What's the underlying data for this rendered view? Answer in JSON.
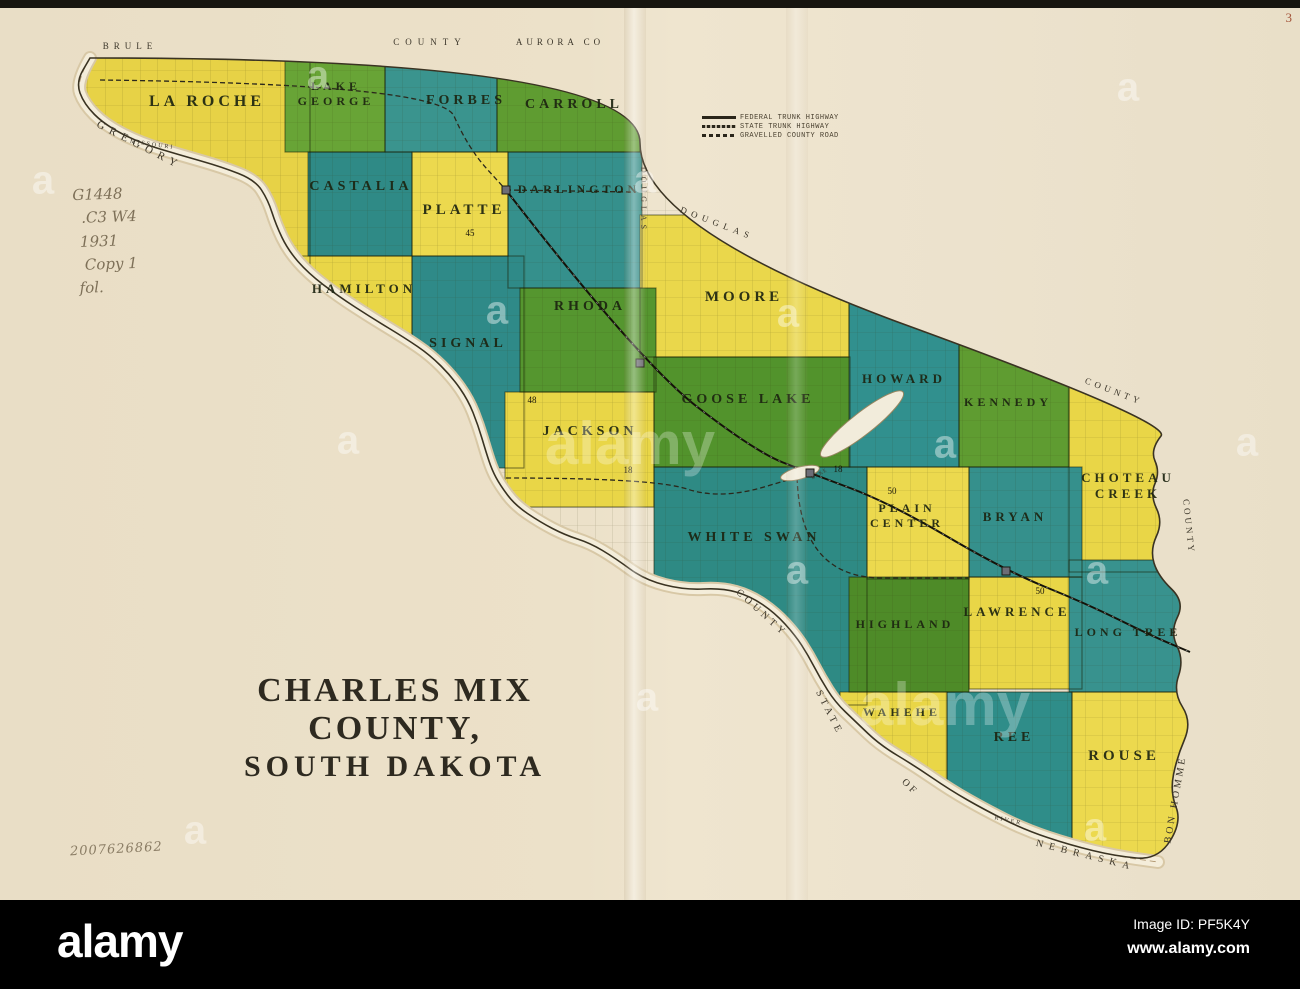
{
  "page": {
    "corner_number": "3",
    "catalog_notes": [
      "G1448",
      ".C3 W4",
      "1931",
      "Copy 1",
      "fol."
    ],
    "accession_number": "2007626862"
  },
  "title": {
    "line1": "CHARLES MIX COUNTY,",
    "line2": "SOUTH DAKOTA"
  },
  "legend": {
    "items": [
      {
        "symbol": "solid",
        "label": "FEDERAL TRUNK HIGHWAY"
      },
      {
        "symbol": "hatched",
        "label": "STATE TRUNK HIGHWAY"
      },
      {
        "symbol": "dashed",
        "label": "GRAVELLED COUNTY ROAD"
      }
    ]
  },
  "map": {
    "colors": {
      "paper": "#ece1c9",
      "ink": "#2b281c",
      "river_band": "#f4edda",
      "river_edge": "#d8c8a6",
      "yellow": "#e9d647",
      "green": "#5f9c31",
      "teal": "#35908c"
    },
    "townships": [
      {
        "name": "LA ROCHE",
        "fill": "#e7d246",
        "x": 70,
        "y": 58,
        "w": 240,
        "h": 210,
        "label": {
          "x": 207,
          "y": 106,
          "size": 16,
          "lines": [
            "LA ROCHE"
          ]
        }
      },
      {
        "name": "LAKE GEORGE",
        "fill": "#68a436",
        "x": 285,
        "y": 58,
        "w": 100,
        "h": 94,
        "label": {
          "x": 336,
          "y": 90,
          "size": 12,
          "lines": [
            "LAKE",
            "GEORGE"
          ]
        }
      },
      {
        "name": "FORBES",
        "fill": "#3a948e",
        "x": 385,
        "y": 58,
        "w": 112,
        "h": 94,
        "label": {
          "x": 466,
          "y": 104,
          "size": 14,
          "lines": [
            "FORBES"
          ]
        }
      },
      {
        "name": "CARROLL",
        "fill": "#5f9c31",
        "x": 497,
        "y": 58,
        "w": 143,
        "h": 94,
        "label": {
          "x": 574,
          "y": 108,
          "size": 14,
          "lines": [
            "CARROLL"
          ]
        }
      },
      {
        "name": "CASTALIA",
        "fill": "#2f8a86",
        "x": 308,
        "y": 152,
        "w": 104,
        "h": 104,
        "label": {
          "x": 361,
          "y": 190,
          "size": 14,
          "lines": [
            "CASTALIA"
          ]
        }
      },
      {
        "name": "PLATTE",
        "fill": "#ecd94e",
        "x": 412,
        "y": 152,
        "w": 96,
        "h": 104,
        "label": {
          "x": 464,
          "y": 214,
          "size": 15,
          "lines": [
            "PLATTE"
          ]
        }
      },
      {
        "name": "DARLINGTON",
        "fill": "#35908c",
        "x": 508,
        "y": 152,
        "w": 134,
        "h": 136,
        "label": {
          "x": 579,
          "y": 193,
          "size": 12,
          "lines": [
            "DARLINGTON"
          ]
        }
      },
      {
        "name": "HAMILTON",
        "fill": "#e9d647",
        "x": 288,
        "y": 256,
        "w": 124,
        "h": 122,
        "label": {
          "x": 364,
          "y": 293,
          "size": 13,
          "lines": [
            "HAMILTON"
          ]
        }
      },
      {
        "name": "MOORE",
        "fill": "#ead74b",
        "x": 640,
        "y": 215,
        "w": 209,
        "h": 142,
        "label": {
          "x": 744,
          "y": 301,
          "size": 15,
          "lines": [
            "MOORE"
          ]
        }
      },
      {
        "name": "SIGNAL",
        "fill": "#2f8a88",
        "x": 412,
        "y": 256,
        "w": 112,
        "h": 212,
        "label": {
          "x": 468,
          "y": 347,
          "size": 14,
          "lines": [
            "SIGNAL"
          ]
        }
      },
      {
        "name": "RHODA",
        "fill": "#55962f",
        "x": 520,
        "y": 288,
        "w": 136,
        "h": 104,
        "label": {
          "x": 590,
          "y": 310,
          "size": 14,
          "lines": [
            "RHODA"
          ]
        }
      },
      {
        "name": "GOOSE LAKE",
        "fill": "#52932c",
        "x": 654,
        "y": 357,
        "w": 196,
        "h": 110,
        "label": {
          "x": 748,
          "y": 403,
          "size": 14,
          "lines": [
            "GOOSE LAKE"
          ]
        }
      },
      {
        "name": "HOWARD",
        "fill": "#31908e",
        "x": 849,
        "y": 288,
        "w": 110,
        "h": 179,
        "label": {
          "x": 904,
          "y": 383,
          "size": 13,
          "lines": [
            "HOWARD"
          ]
        }
      },
      {
        "name": "KENNEDY",
        "fill": "#5f9c31",
        "x": 959,
        "y": 330,
        "w": 110,
        "h": 137,
        "label": {
          "x": 1008,
          "y": 406,
          "size": 12,
          "lines": [
            "KENNEDY"
          ]
        }
      },
      {
        "name": "JACKSON",
        "fill": "#e9d647",
        "x": 505,
        "y": 392,
        "w": 149,
        "h": 115,
        "label": {
          "x": 590,
          "y": 435,
          "size": 14,
          "lines": [
            "JACKSON"
          ]
        }
      },
      {
        "name": "CHOTEAU CREEK",
        "fill": "#e9d647",
        "x": 1069,
        "y": 385,
        "w": 118,
        "h": 187,
        "label": {
          "x": 1128,
          "y": 482,
          "size": 13,
          "lines": [
            "CHOTEAU",
            "CREEK"
          ]
        }
      },
      {
        "name": "WHITE SWAN",
        "fill": "#2e8a84",
        "x": 654,
        "y": 467,
        "w": 213,
        "h": 238,
        "label": {
          "x": 754,
          "y": 541,
          "size": 14,
          "lines": [
            "WHITE SWAN"
          ]
        }
      },
      {
        "name": "PLAIN CENTER",
        "fill": "#ecd94e",
        "x": 867,
        "y": 467,
        "w": 102,
        "h": 112,
        "label": {
          "x": 907,
          "y": 512,
          "size": 12,
          "lines": [
            "PLAIN",
            "CENTER"
          ]
        }
      },
      {
        "name": "BRYAN",
        "fill": "#35908c",
        "x": 969,
        "y": 467,
        "w": 113,
        "h": 110,
        "label": {
          "x": 1015,
          "y": 521,
          "size": 13,
          "lines": [
            "BRYAN"
          ]
        }
      },
      {
        "name": "HIGHLAND",
        "fill": "#4e8b28",
        "x": 849,
        "y": 577,
        "w": 120,
        "h": 115,
        "label": {
          "x": 905,
          "y": 628,
          "size": 12,
          "lines": [
            "HIGHLAND"
          ]
        }
      },
      {
        "name": "LAWRENCE",
        "fill": "#e9d647",
        "x": 969,
        "y": 577,
        "w": 113,
        "h": 112,
        "label": {
          "x": 1017,
          "y": 616,
          "size": 13,
          "lines": [
            "LAWRENCE"
          ]
        }
      },
      {
        "name": "LONG TREE",
        "fill": "#38928e",
        "x": 1069,
        "y": 560,
        "w": 120,
        "h": 132,
        "label": {
          "x": 1128,
          "y": 636,
          "size": 12,
          "lines": [
            "LONG TREE"
          ]
        }
      },
      {
        "name": "WAHEHE",
        "fill": "#e9d647",
        "x": 840,
        "y": 692,
        "w": 107,
        "h": 118,
        "label": {
          "x": 902,
          "y": 716,
          "size": 12,
          "lines": [
            "WAHEHE"
          ]
        }
      },
      {
        "name": "REE",
        "fill": "#2f8d89",
        "x": 947,
        "y": 692,
        "w": 125,
        "h": 150,
        "label": {
          "x": 1014,
          "y": 741,
          "size": 14,
          "lines": [
            "REE"
          ]
        }
      },
      {
        "name": "ROUSE",
        "fill": "#ecd94e",
        "x": 1072,
        "y": 692,
        "w": 118,
        "h": 166,
        "label": {
          "x": 1124,
          "y": 760,
          "size": 15,
          "lines": [
            "ROUSE"
          ]
        }
      }
    ],
    "county_outline": [
      [
        95,
        58
      ],
      [
        640,
        58
      ],
      [
        640,
        228
      ],
      [
        1172,
        422
      ],
      [
        1150,
        450
      ],
      [
        1160,
        472
      ],
      [
        1150,
        495
      ],
      [
        1163,
        522
      ],
      [
        1150,
        550
      ],
      [
        1158,
        576
      ],
      [
        1185,
        602
      ],
      [
        1170,
        632
      ],
      [
        1184,
        660
      ],
      [
        1173,
        692
      ],
      [
        1192,
        722
      ],
      [
        1177,
        757
      ],
      [
        1170,
        792
      ],
      [
        1182,
        822
      ],
      [
        1158,
        860
      ],
      [
        1115,
        856
      ],
      [
        1070,
        845
      ],
      [
        1025,
        830
      ],
      [
        985,
        810
      ],
      [
        950,
        790
      ],
      [
        915,
        766
      ],
      [
        880,
        745
      ],
      [
        856,
        722
      ],
      [
        835,
        702
      ],
      [
        820,
        678
      ],
      [
        808,
        655
      ],
      [
        795,
        635
      ],
      [
        775,
        613
      ],
      [
        750,
        596
      ],
      [
        722,
        588
      ],
      [
        685,
        590
      ],
      [
        645,
        580
      ],
      [
        615,
        558
      ],
      [
        590,
        543
      ],
      [
        565,
        535
      ],
      [
        540,
        522
      ],
      [
        515,
        505
      ],
      [
        500,
        485
      ],
      [
        492,
        470
      ],
      [
        486,
        452
      ],
      [
        478,
        425
      ],
      [
        468,
        400
      ],
      [
        452,
        377
      ],
      [
        430,
        355
      ],
      [
        405,
        338
      ],
      [
        372,
        318
      ],
      [
        338,
        296
      ],
      [
        308,
        273
      ],
      [
        288,
        250
      ],
      [
        276,
        225
      ],
      [
        268,
        200
      ],
      [
        255,
        180
      ],
      [
        222,
        167
      ],
      [
        180,
        155
      ],
      [
        140,
        143
      ],
      [
        105,
        125
      ],
      [
        84,
        104
      ],
      [
        76,
        82
      ],
      [
        90,
        58
      ]
    ],
    "river_path": [
      [
        90,
        58
      ],
      [
        76,
        82
      ],
      [
        84,
        104
      ],
      [
        105,
        125
      ],
      [
        140,
        143
      ],
      [
        180,
        155
      ],
      [
        222,
        167
      ],
      [
        255,
        180
      ],
      [
        268,
        200
      ],
      [
        276,
        225
      ],
      [
        288,
        250
      ],
      [
        308,
        273
      ],
      [
        338,
        296
      ],
      [
        372,
        318
      ],
      [
        405,
        338
      ],
      [
        430,
        355
      ],
      [
        452,
        377
      ],
      [
        468,
        400
      ],
      [
        478,
        425
      ],
      [
        486,
        452
      ],
      [
        492,
        470
      ],
      [
        500,
        485
      ],
      [
        515,
        505
      ],
      [
        540,
        522
      ],
      [
        565,
        535
      ],
      [
        590,
        543
      ],
      [
        615,
        558
      ],
      [
        645,
        580
      ],
      [
        685,
        590
      ],
      [
        722,
        588
      ],
      [
        750,
        596
      ],
      [
        775,
        613
      ],
      [
        795,
        635
      ],
      [
        808,
        655
      ],
      [
        820,
        678
      ],
      [
        835,
        702
      ],
      [
        856,
        722
      ],
      [
        880,
        745
      ],
      [
        915,
        766
      ],
      [
        950,
        790
      ],
      [
        985,
        810
      ],
      [
        1025,
        830
      ],
      [
        1070,
        845
      ],
      [
        1115,
        856
      ],
      [
        1158,
        862
      ]
    ],
    "railroad_path": [
      [
        506,
        190
      ],
      [
        640,
        363
      ],
      [
        756,
        452
      ],
      [
        810,
        473
      ],
      [
        890,
        503
      ],
      [
        1006,
        571
      ],
      [
        1085,
        603
      ],
      [
        1152,
        636
      ],
      [
        1190,
        652
      ]
    ],
    "dashed_roads": [
      [
        [
          100,
          80
        ],
        [
          440,
          84
        ],
        [
          468,
          148
        ],
        [
          506,
          190
        ]
      ],
      [
        [
          506,
          190
        ],
        [
          636,
          192
        ]
      ],
      [
        [
          506,
          478
        ],
        [
          654,
          478
        ],
        [
          720,
          500
        ],
        [
          808,
          474
        ]
      ],
      [
        [
          797,
          470
        ],
        [
          797,
          578
        ],
        [
          968,
          578
        ]
      ]
    ],
    "towns": [
      [
        506,
        190
      ],
      [
        640,
        363
      ],
      [
        810,
        473
      ],
      [
        1006,
        571
      ]
    ],
    "route_numbers": [
      {
        "n": "45",
        "x": 470,
        "y": 236
      },
      {
        "n": "48",
        "x": 532,
        "y": 403
      },
      {
        "n": "18",
        "x": 628,
        "y": 473
      },
      {
        "n": "18",
        "x": 838,
        "y": 472
      },
      {
        "n": "50",
        "x": 892,
        "y": 494
      },
      {
        "n": "50",
        "x": 1040,
        "y": 594
      }
    ],
    "lakes": [
      {
        "cx": 862,
        "cy": 424,
        "rx": 52,
        "ry": 11,
        "rot": -38
      },
      {
        "cx": 800,
        "cy": 473,
        "rx": 20,
        "ry": 6,
        "rot": -15
      }
    ],
    "border_labels": [
      {
        "text": "BRULE",
        "x": 130,
        "y": 49,
        "rot": 0,
        "size": 9,
        "ls": 5
      },
      {
        "text": "COUNTY",
        "x": 430,
        "y": 45,
        "rot": 0,
        "size": 9,
        "ls": 6
      },
      {
        "text": "AURORA CO",
        "x": 560,
        "y": 45,
        "rot": 0,
        "size": 9,
        "ls": 4
      },
      {
        "text": "GREGORY",
        "x": 138,
        "y": 148,
        "rot": 27,
        "size": 11,
        "ls": 6
      },
      {
        "text": "MISSOURI",
        "x": 152,
        "y": 146,
        "rot": 8,
        "size": 6,
        "ls": 2
      },
      {
        "text": "DOUGLAS",
        "x": 641,
        "y": 200,
        "rot": 90,
        "size": 8,
        "ls": 4
      },
      {
        "text": "DOUGLAS",
        "x": 716,
        "y": 226,
        "rot": 21,
        "size": 9,
        "ls": 5
      },
      {
        "text": "COUNTY",
        "x": 1113,
        "y": 394,
        "rot": 21,
        "size": 9,
        "ls": 4
      },
      {
        "text": "COUNTY",
        "x": 1186,
        "y": 527,
        "rot": 84,
        "size": 9,
        "ls": 3
      },
      {
        "text": "COUNTY",
        "x": 760,
        "y": 615,
        "rot": 42,
        "size": 10,
        "ls": 4
      },
      {
        "text": "STATE",
        "x": 827,
        "y": 714,
        "rot": 63,
        "size": 10,
        "ls": 4
      },
      {
        "text": "OF",
        "x": 908,
        "y": 789,
        "rot": 45,
        "size": 10,
        "ls": 3
      },
      {
        "text": "NEBRASKA",
        "x": 1085,
        "y": 858,
        "rot": 14,
        "size": 10,
        "ls": 6
      },
      {
        "text": "BON HOMME",
        "x": 1178,
        "y": 800,
        "rot": -80,
        "size": 10,
        "ls": 3
      },
      {
        "text": "RIVER",
        "x": 1008,
        "y": 822,
        "rot": 12,
        "size": 6,
        "ls": 2
      },
      {
        "text": "LAKE",
        "x": 820,
        "y": 475,
        "rot": -30,
        "size": 5,
        "ls": 1
      }
    ]
  },
  "watermark": {
    "tile_letter": "a",
    "word": "alamy",
    "letter_positions": [
      [
        43,
        183
      ],
      [
        318,
        78
      ],
      [
        645,
        182
      ],
      [
        1128,
        90
      ],
      [
        497,
        313
      ],
      [
        788,
        316
      ],
      [
        348,
        443
      ],
      [
        945,
        447
      ],
      [
        1247,
        445
      ],
      [
        1097,
        573
      ],
      [
        797,
        573
      ],
      [
        647,
        700
      ],
      [
        195,
        833
      ],
      [
        1095,
        830
      ]
    ],
    "word_positions": [
      [
        630,
        447
      ],
      [
        945,
        708
      ]
    ]
  },
  "footer": {
    "logo": "alamy",
    "image_id": "Image ID: PF5K4Y",
    "site": "www.alamy.com"
  }
}
